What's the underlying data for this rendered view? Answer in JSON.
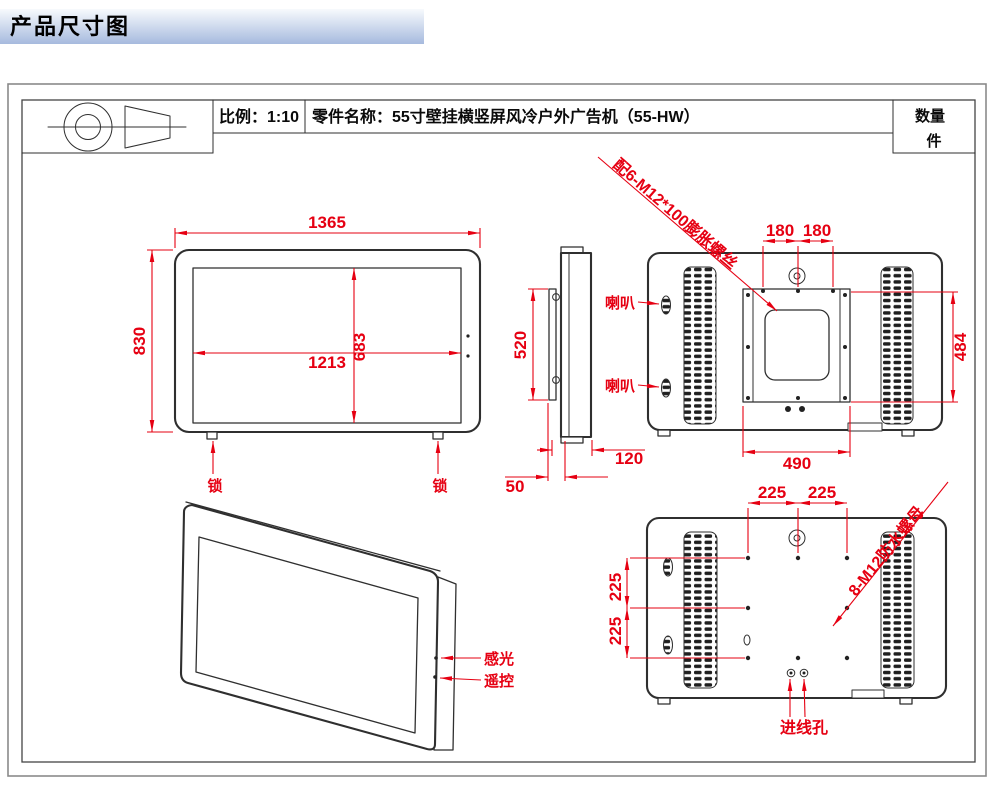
{
  "header": {
    "title": "产品尺寸图"
  },
  "title_block": {
    "scale": "比例：1:10",
    "part_name": "零件名称：55寸壁挂横竖屏风冷户外广告机（55-HW）",
    "quantity_label": "数量",
    "quantity_unit": "件"
  },
  "front_view": {
    "overall_width": "1365",
    "overall_height": "830",
    "screen_width": "1213",
    "screen_height": "683",
    "lock_left": "锁",
    "lock_right": "锁"
  },
  "side_view": {
    "mount_height": "520",
    "body_depth": "120",
    "mount_depth": "50"
  },
  "back_view": {
    "speaker_top": "喇叭",
    "speaker_bottom": "喇叭",
    "anchor_note": "配6-M12*100膨胀螺丝",
    "hole_span_left": "180",
    "hole_span_right": "180",
    "mount_width": "490",
    "mount_height": "484"
  },
  "bottom_back_view": {
    "top_span_left": "225",
    "top_span_right": "225",
    "left_span_top": "225",
    "left_span_bottom": "225",
    "nut_note": "8-M12防水螺母",
    "cable_entry": "进线孔"
  },
  "perspective_view": {
    "light_sensor": "感光",
    "remote_control": "遥控"
  },
  "colors": {
    "dimension": "#e60012",
    "outline": "#2f2f2f",
    "header_top": "#f7fafd",
    "header_bottom": "#a6bade"
  }
}
